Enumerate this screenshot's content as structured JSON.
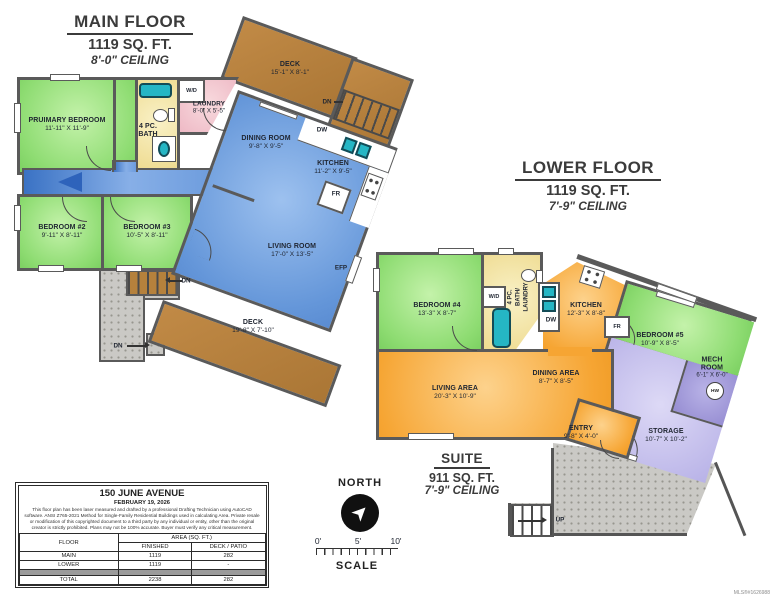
{
  "mls": "MLS®#1626988",
  "main_floor": {
    "title": "MAIN FLOOR",
    "area": "1119 SQ. FT.",
    "ceiling": "8'-0\" CEILING",
    "primary_bedroom": {
      "name": "PRUIMARY BEDROOM",
      "dims": "11'-11\" X 11'-9\""
    },
    "bath": {
      "line1": "4 PC.",
      "line2": "BATH"
    },
    "wd": "W/D",
    "laundry": {
      "name": "LAUNDRY",
      "dims": "8'-0\" X 5'-5\""
    },
    "dining": {
      "name": "DINING ROOM",
      "dims": "9'-8\" X 9'-5\""
    },
    "kitchen": {
      "name": "KITCHEN",
      "dims": "11'-2\" X 9'-5\""
    },
    "living": {
      "name": "LIVING ROOM",
      "dims": "17'-0\" X 13'-5\""
    },
    "bedroom2": {
      "name": "BEDROOM #2",
      "dims": "9'-11\" X 8'-11\""
    },
    "bedroom3": {
      "name": "BEDROOM #3",
      "dims": "10'-5\" X 8'-11\""
    },
    "deck_upper": {
      "name": "DECK",
      "dims": "15'-1\" X 8'-1\""
    },
    "deck_lower": {
      "name": "DECK",
      "dims": "19'-8\" X 7'-10\""
    },
    "dw": "DW",
    "fr": "FR",
    "efp": "EFP",
    "dn": "DN"
  },
  "lower_floor": {
    "title": "LOWER FLOOR",
    "area": "1119 SQ. FT.",
    "ceiling": "7'-9\" CEILING",
    "bedroom4": {
      "name": "BEDROOM #4",
      "dims": "13'-3\" X 8'-7\""
    },
    "bath": {
      "line1": "4 PC.",
      "line2": "BATH/",
      "line3": "LAUNDRY"
    },
    "wd": "W/D",
    "kitchen": {
      "name": "KITCHEN",
      "dims": "12'-3\" X 8'-8\""
    },
    "living": {
      "name": "LIVING AREA",
      "dims": "20'-3\" X 10'-9\""
    },
    "dining": {
      "name": "DINING AREA",
      "dims": "8'-7\" X 8'-5\""
    },
    "entry": {
      "name": "ENTRY",
      "dims": "9'-8\" X 4'-0\""
    },
    "bedroom5": {
      "name": "BEDROOM #5",
      "dims": "10'-9\" X 8'-5\""
    },
    "mech": {
      "name": "MECH ROOM",
      "dims": "6'-1\" X 6'-0\"",
      "tank": "HW"
    },
    "storage": {
      "name": "STORAGE",
      "dims": "10'-7\" X 10'-2\""
    },
    "dw": "DW",
    "fr": "FR",
    "up": "UP"
  },
  "suite": {
    "title": "SUITE",
    "area": "911 SQ. FT.",
    "ceiling": "7'-9\" CEILING"
  },
  "compass": {
    "label": "NORTH"
  },
  "scale": {
    "t0": "0'",
    "t5": "5'",
    "t10": "10'",
    "label": "SCALE"
  },
  "title_block": {
    "address": "150 JUNE AVENUE",
    "date": "FEBRUARY 19, 2026",
    "disclaimer": "This floor plan has been laser measured and drafted by a professional Drafting Technician using AutoCAD software. ANSI Z765-2021 Method for Single-Family Residential Buildings used in calculating Area. Private resale or modification of this copyrighted document to a third party by any individual or entity, other than the original creator is strictly prohibited. Plans may not be 100% accurate. Buyer must verify any critical measurement.",
    "table": {
      "floor": "FLOOR",
      "area": "AREA (SQ. FT.)",
      "finished": "FINISHED",
      "deck": "DECK / PATIO",
      "rows": [
        {
          "floor": "MAIN",
          "finished": "1119",
          "deck": "282"
        },
        {
          "floor": "LOWER",
          "finished": "1119",
          "deck": "-"
        }
      ],
      "total": {
        "floor": "TOTAL",
        "finished": "2238",
        "deck": "282"
      }
    }
  },
  "colors": {
    "wall": "#5a5a5a",
    "green": "#8edc72",
    "blue": "#6496d9",
    "orange": "#f6a533",
    "yellow": "#eeda8e",
    "pink": "#eeb9c5",
    "deck": "#b5813c",
    "lavender": "#b8b2e7",
    "teal": "#25b6c4",
    "concrete": "#cac9c5"
  }
}
